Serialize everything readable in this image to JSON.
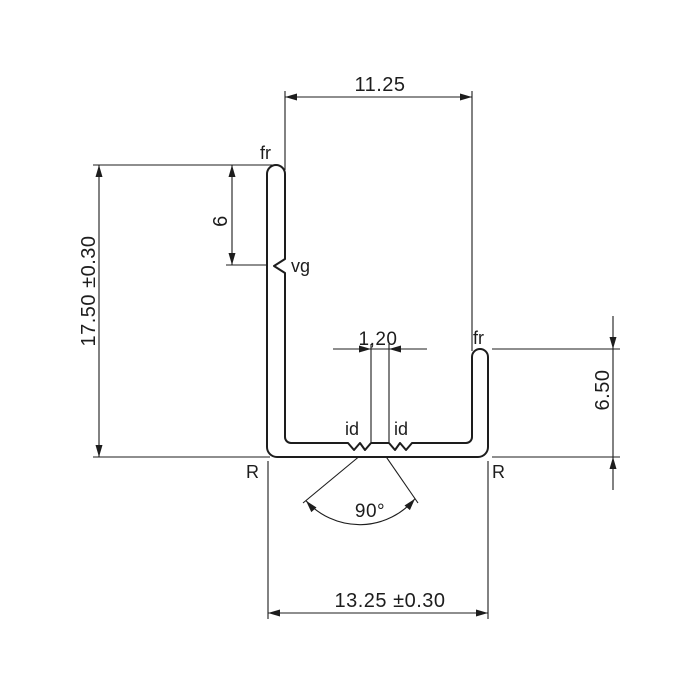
{
  "dims": {
    "top_width": "11.25",
    "overall_height": "17.50 ±0.30",
    "vg_offset": "6",
    "groove_gap": "1,20",
    "right_flange_height": "6.50",
    "bottom_width": "13.25 ±0.30",
    "groove_angle": "90°"
  },
  "labels": {
    "fr_left": "fr",
    "fr_right": "fr",
    "vg": "vg",
    "id_left": "id",
    "id_right": "id",
    "radius_left": "R",
    "radius_right": "R"
  },
  "colors": {
    "line_color": "#1d1d1d",
    "background": "#ffffff"
  }
}
